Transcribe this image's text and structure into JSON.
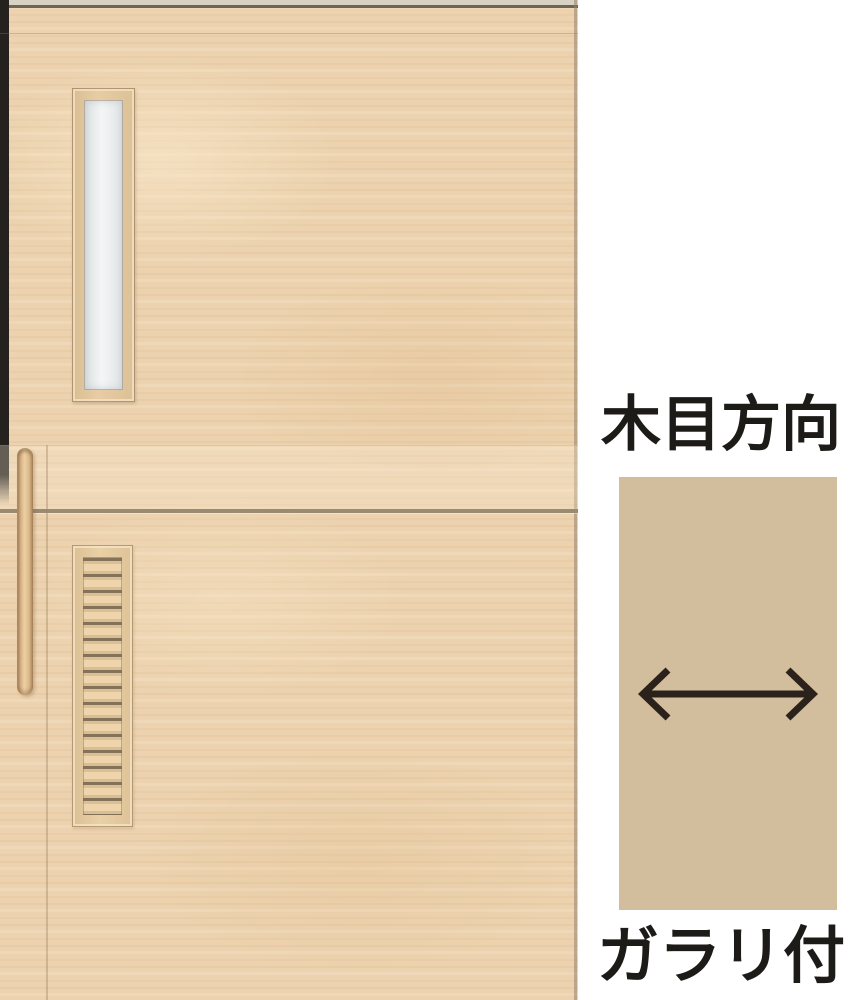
{
  "annotations": {
    "grain_direction_label": "木目方向",
    "louver_label": "ガラリ付"
  },
  "icons": {
    "grain_arrow": "double-headed-horizontal-arrow"
  },
  "colors": {
    "door_wood": "#ecd2ae",
    "swatch_tan": "#d2bd9d",
    "label_text": "#1d1b17",
    "arrow_stroke": "#2b221c",
    "seam": "#998a71"
  }
}
